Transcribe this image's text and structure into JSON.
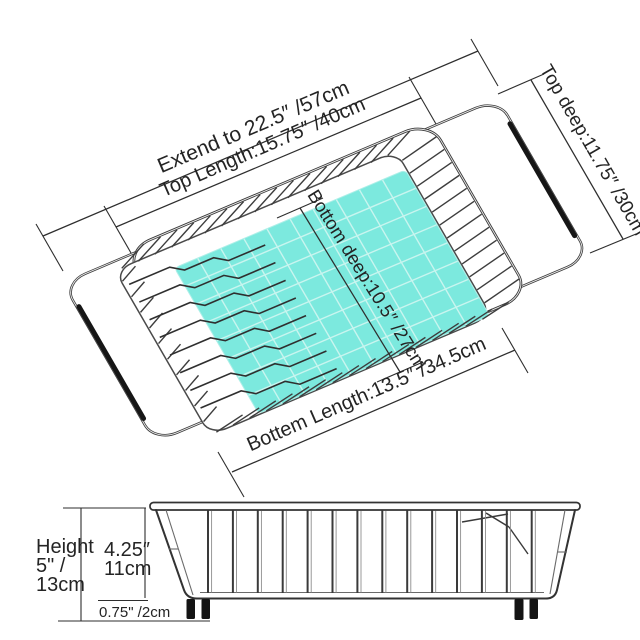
{
  "top_view": {
    "extend": "Extend to 22.5″ /57cm",
    "top_length": "Top Length:15.75″ /40cm",
    "top_deep": "Top deep:11.75″ /30cm",
    "bottom_deep": "Bottom deep:10.5″ /27cm",
    "bottom_length": "Bottem Length:13.5″ /34.5cm"
  },
  "side_view": {
    "height_line1": "Height",
    "height_line2": "5\" /",
    "height_line3": "13cm",
    "basket_height_line1": "4.25″",
    "basket_height_line2": "11cm",
    "feet_height": "0.75\" /2cm"
  },
  "colors": {
    "mat": "#7CE9DE",
    "mat_edge": "#AEEFE8",
    "line": "#2E2E2E",
    "grip": "#161616"
  }
}
